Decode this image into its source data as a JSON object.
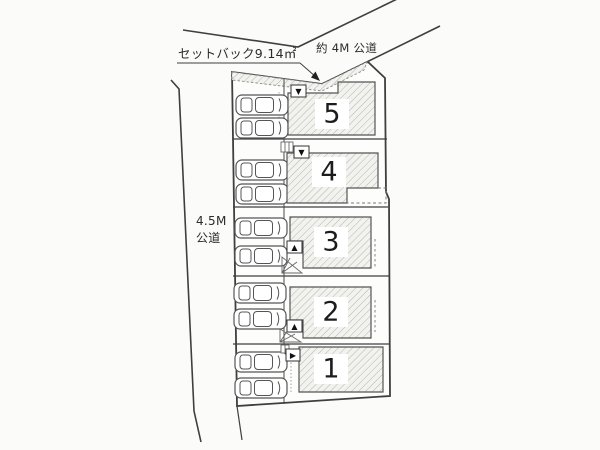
{
  "labels": {
    "setback_note": "セットバック9.14㎡",
    "top_road": "約 4M 公道",
    "left_road_line1": "4.5M",
    "left_road_line2": "公道"
  },
  "lots": [
    {
      "number": "1",
      "entrance_marker": "▶"
    },
    {
      "number": "2",
      "entrance_marker": "▲"
    },
    {
      "number": "3",
      "entrance_marker": "▲"
    },
    {
      "number": "4",
      "entrance_marker": "▼"
    },
    {
      "number": "5",
      "entrance_marker": "▼"
    }
  ],
  "parking": {
    "cars_per_lot": 2
  },
  "colors": {
    "line": "#3f3f3f",
    "hatch_line": "#b5b5b0",
    "building_fill": "#f2f2ee",
    "background": "#fbfbfa"
  }
}
